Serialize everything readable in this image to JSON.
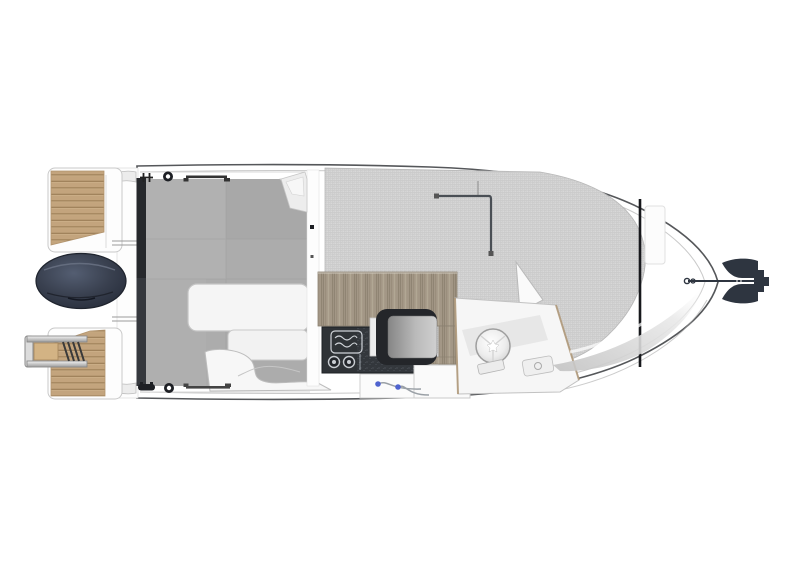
{
  "colors": {
    "background": "#ffffff",
    "hull_white": "#ffffff",
    "hull_outline": "#55575a",
    "sheer_line": "#c9c9c9",
    "cockpit_floor": "#acacac",
    "transom_strip": "#35383d",
    "transom_strip_dark": "#26282c",
    "teak": "#c3a47d",
    "teak_gap": "#a1835c",
    "ladder_step": "#d3b384",
    "sunpad_base": "#d5d5d5",
    "sunpad_grid": "#c9c9c9",
    "wood_counter": "#a39786",
    "wood_grain": "#8d8170",
    "galley_dark": "#2f3337",
    "galley_granite": "#33373c",
    "stove_line": "#cfd3d8",
    "seat_frame": "#24262a",
    "engine_light": "#545e72",
    "engine_mid": "#39404f",
    "engine_dark": "#262c3a",
    "anchor": "#2e3540",
    "handle_blue": "#4f63cf",
    "windshield": "#17181c",
    "fitting_dark": "#1d1f24",
    "rail_gray": "#4a4f55",
    "trim_gray": "#c4c4c4",
    "bench_white": "#f5f5f5",
    "console_white": "#f6f6f6",
    "shade_gray": "#c2c2c2"
  },
  "components": [
    "hull",
    "swim-platform-port",
    "swim-platform-starboard",
    "boarding-ladder",
    "outboard-engine",
    "transom-bulkhead",
    "mooring-cleat",
    "ring-bollard",
    "grab-rail",
    "cockpit-floor",
    "cockpit-bench",
    "wheelhouse-bulkhead",
    "galley-counter",
    "galley-stove",
    "stove-knobs",
    "helm-seat",
    "storage-drawers",
    "helm-console",
    "steering-wheel",
    "bow-sunpad",
    "roof-rail",
    "windshield",
    "foredeck-hatch",
    "bow-anchor"
  ]
}
